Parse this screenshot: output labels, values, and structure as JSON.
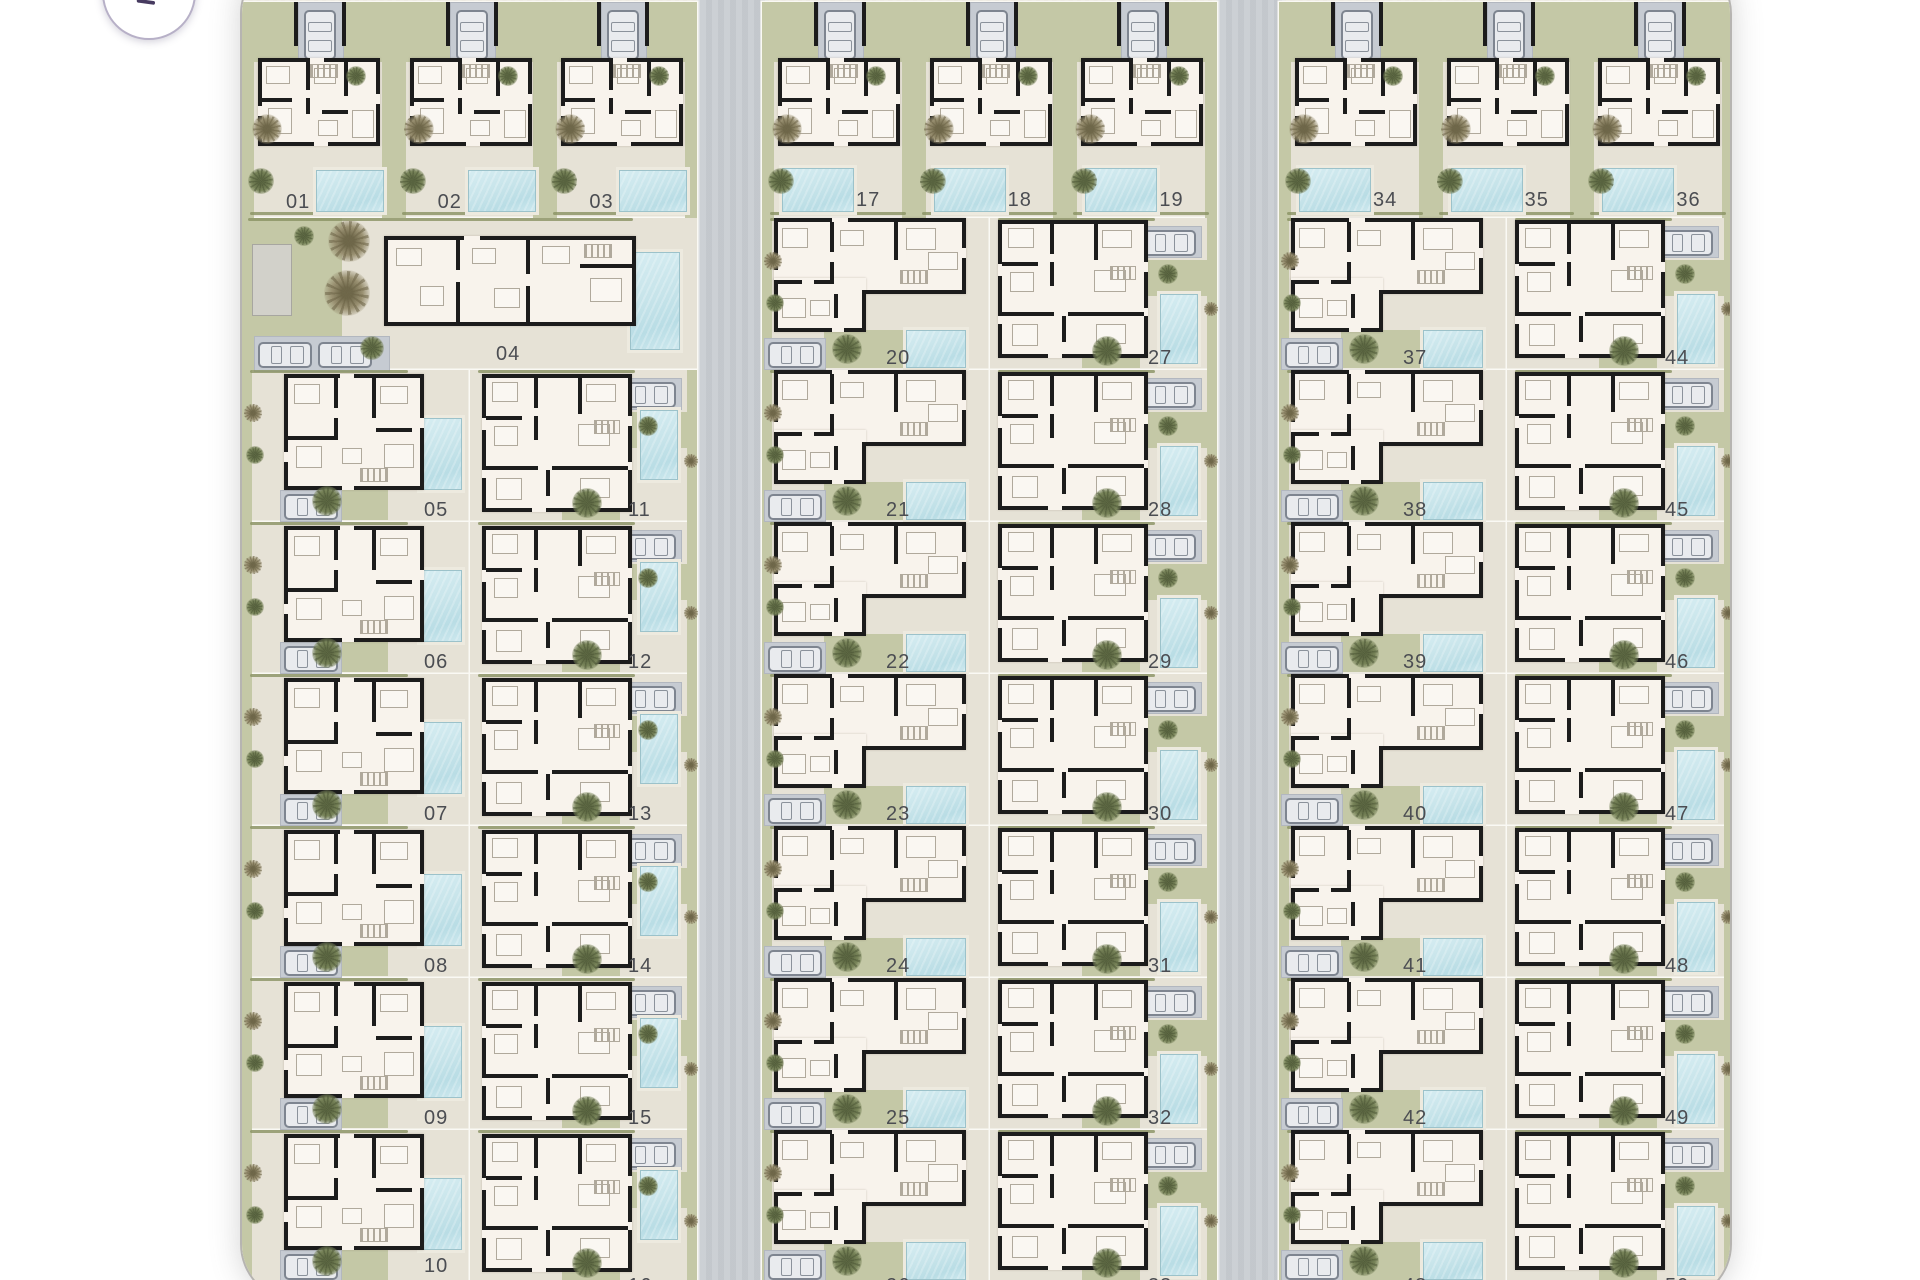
{
  "app": {
    "view": "residential development site plan",
    "back_button": {
      "icon": "arrow-up-left-icon",
      "action_label": "back"
    }
  },
  "colors": {
    "outside": "#ffffff",
    "ground": "#e6e2d6",
    "green": "#c4c8a6",
    "green_dark": "#8a9263",
    "road": "#c9cdd2",
    "curb": "#dadde0",
    "parking": "#c6cbd2",
    "parking_border": "#b2b7bf",
    "pool": "#c7e4ea",
    "pool_deep": "#b9dde5",
    "pool_edge": "#9cc2ca",
    "deck": "#edeadf",
    "wall": "#1c1c1c",
    "interior": "#f8f3ec",
    "furniture": "#b0a99c",
    "label": "#4b4d52",
    "divider": "#faf9f4",
    "boundary": "#b6b4b1",
    "car_line": "#7e8590",
    "car_fill": "#e9ebee",
    "utility": "#d2d1ca",
    "button_border": "#b7b0c7",
    "button_arrow": "#473b60",
    "shadow": "rgba(110,110,110,0.30)"
  },
  "site": {
    "blocks": [
      "A",
      "B",
      "C"
    ],
    "roads": [
      {
        "name": "road-1"
      },
      {
        "name": "road-2"
      }
    ],
    "units": [
      {
        "number": "01",
        "block": "A",
        "variant": "top",
        "col": 0
      },
      {
        "number": "02",
        "block": "A",
        "variant": "top",
        "col": 1
      },
      {
        "number": "03",
        "block": "A",
        "variant": "top",
        "col": 2
      },
      {
        "number": "04",
        "block": "A",
        "variant": "wide",
        "row": 1
      },
      {
        "number": "05",
        "block": "A",
        "variant": "colL",
        "row": 2,
        "cars": 1
      },
      {
        "number": "06",
        "block": "A",
        "variant": "colL",
        "row": 3
      },
      {
        "number": "07",
        "block": "A",
        "variant": "colL",
        "row": 4
      },
      {
        "number": "08",
        "block": "A",
        "variant": "colL",
        "row": 5
      },
      {
        "number": "09",
        "block": "A",
        "variant": "colL",
        "row": 6
      },
      {
        "number": "10",
        "block": "A",
        "variant": "colL",
        "row": 7
      },
      {
        "number": "11",
        "block": "A",
        "variant": "colR",
        "row": 2
      },
      {
        "number": "12",
        "block": "A",
        "variant": "colR",
        "row": 3
      },
      {
        "number": "13",
        "block": "A",
        "variant": "colR",
        "row": 4
      },
      {
        "number": "14",
        "block": "A",
        "variant": "colR",
        "row": 5
      },
      {
        "number": "15",
        "block": "A",
        "variant": "colR",
        "row": 6
      },
      {
        "number": "16",
        "block": "A",
        "variant": "colR",
        "row": 7,
        "clipped": true
      },
      {
        "number": "17",
        "block": "B",
        "variant": "top",
        "col": 0
      },
      {
        "number": "18",
        "block": "B",
        "variant": "top",
        "col": 1
      },
      {
        "number": "19",
        "block": "B",
        "variant": "top",
        "col": 2
      },
      {
        "number": "20",
        "block": "B",
        "variant": "colL",
        "row": 1
      },
      {
        "number": "21",
        "block": "B",
        "variant": "colL",
        "row": 2
      },
      {
        "number": "22",
        "block": "B",
        "variant": "colL",
        "row": 3
      },
      {
        "number": "23",
        "block": "B",
        "variant": "colL",
        "row": 4
      },
      {
        "number": "24",
        "block": "B",
        "variant": "colL",
        "row": 5
      },
      {
        "number": "25",
        "block": "B",
        "variant": "colL",
        "row": 6
      },
      {
        "number": "26",
        "block": "B",
        "variant": "colL",
        "row": 7,
        "clipped": true
      },
      {
        "number": "27",
        "block": "B",
        "variant": "colR",
        "row": 1
      },
      {
        "number": "28",
        "block": "B",
        "variant": "colR",
        "row": 2
      },
      {
        "number": "29",
        "block": "B",
        "variant": "colR",
        "row": 3
      },
      {
        "number": "30",
        "block": "B",
        "variant": "colR",
        "row": 4
      },
      {
        "number": "31",
        "block": "B",
        "variant": "colR",
        "row": 5
      },
      {
        "number": "32",
        "block": "B",
        "variant": "colR",
        "row": 6
      },
      {
        "number": "33",
        "block": "B",
        "variant": "colR",
        "row": 7,
        "clipped": true
      },
      {
        "number": "34",
        "block": "C",
        "variant": "top",
        "col": 0
      },
      {
        "number": "35",
        "block": "C",
        "variant": "top",
        "col": 1
      },
      {
        "number": "36",
        "block": "C",
        "variant": "top",
        "col": 2
      },
      {
        "number": "37",
        "block": "C",
        "variant": "colL",
        "row": 1
      },
      {
        "number": "38",
        "block": "C",
        "variant": "colL",
        "row": 2
      },
      {
        "number": "39",
        "block": "C",
        "variant": "colL",
        "row": 3
      },
      {
        "number": "40",
        "block": "C",
        "variant": "colL",
        "row": 4
      },
      {
        "number": "41",
        "block": "C",
        "variant": "colL",
        "row": 5
      },
      {
        "number": "42",
        "block": "C",
        "variant": "colL",
        "row": 6
      },
      {
        "number": "43",
        "block": "C",
        "variant": "colL",
        "row": 7,
        "clipped": true
      },
      {
        "number": "44",
        "block": "C",
        "variant": "colR",
        "row": 1
      },
      {
        "number": "45",
        "block": "C",
        "variant": "colR",
        "row": 2
      },
      {
        "number": "46",
        "block": "C",
        "variant": "colR",
        "row": 3
      },
      {
        "number": "47",
        "block": "C",
        "variant": "colR",
        "row": 4
      },
      {
        "number": "48",
        "block": "C",
        "variant": "colR",
        "row": 5
      },
      {
        "number": "49",
        "block": "C",
        "variant": "colR",
        "row": 6
      },
      {
        "number": "50",
        "block": "C",
        "variant": "colR",
        "row": 7,
        "clipped": true
      }
    ]
  }
}
